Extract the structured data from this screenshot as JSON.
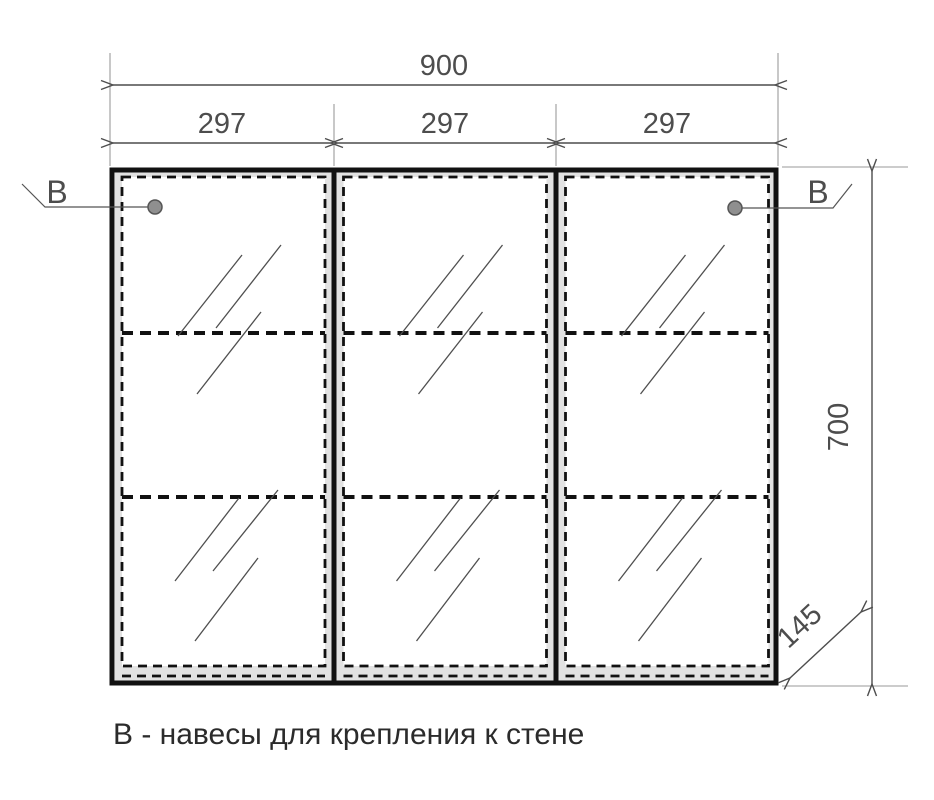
{
  "drawing": {
    "kind": "furniture-technical-drawing",
    "dims": {
      "total_width": "900",
      "door_width_1": "297",
      "door_width_2": "297",
      "door_width_3": "297",
      "height": "700",
      "depth": "145"
    },
    "callouts": {
      "left": "В",
      "right": "В"
    },
    "note": "В - навесы для крепления к стене",
    "colors": {
      "background": "#ffffff",
      "outline": "#111111",
      "dimension_line": "#4d4d4d",
      "extension_line": "#9a9a9a",
      "dimension_text": "#4d4d4d",
      "note_text": "#2b2b2b",
      "door_face": "#e2e2e2",
      "glass": "#ffffff",
      "hatch_line": "#4f4f4f",
      "mount_point_fill": "#8f8f8f",
      "mount_point_stroke": "#555555"
    }
  }
}
